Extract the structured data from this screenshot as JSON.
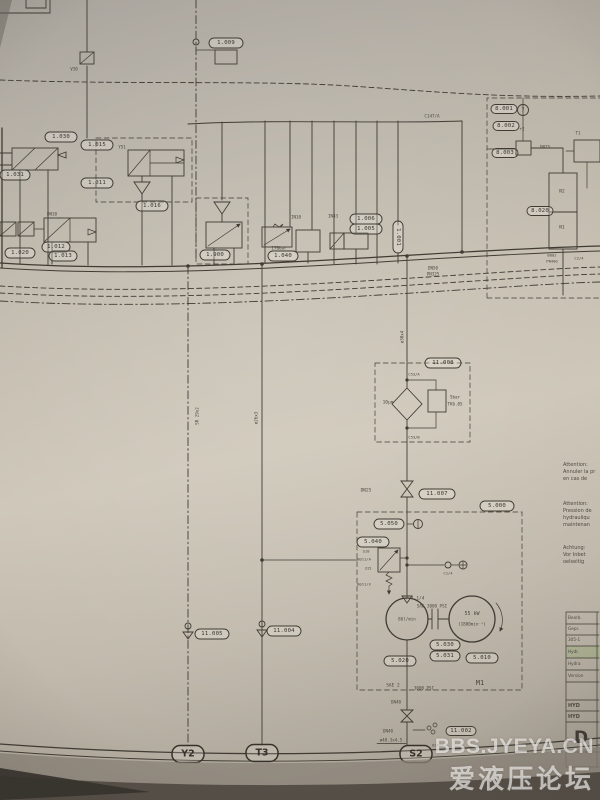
{
  "watermark": {
    "line1": "BBS.JYEYA.CN",
    "line2": "爱液压论坛"
  },
  "terminals": {
    "y2": "Y2",
    "t3": "T3",
    "s2": "S2"
  },
  "tags": {
    "t1009": "1.009",
    "t1030": "1.030",
    "t1031": "1.031",
    "t1015": "1.015",
    "t1011": "1.011",
    "t1016": "1.016",
    "t1020": "1.020",
    "t1012": "1.012",
    "t1013": "1.013",
    "t1900": "1.900",
    "t1040": "1.040",
    "t1006": "1.006",
    "t1005": "1.005",
    "t1001": "1.001",
    "t11008": "11.008",
    "t11007": "11.007",
    "t5000": "5.000",
    "t5050": "5.050",
    "t5040": "5.040",
    "t5020": "5.020",
    "t5030": "5.030",
    "t5031": "5.031",
    "t5010": "5.010",
    "t11005": "11.005",
    "t11004": "11.004",
    "t11002": "11.002",
    "t8001": "8.001",
    "t8002": "8.002",
    "t8003": "8.003",
    "t8020": "8.020",
    "detail7": "7"
  },
  "texts": {
    "v30": "V30",
    "y51": "Y51",
    "dn10": "DN10",
    "in10": "IN10",
    "in43": "IN43",
    "bar170": "170bar",
    "dn50": "DN50",
    "pn325": "PN325",
    "c147": "C147/A",
    "t1": "T1",
    "n2": "N2",
    "n1": "N1",
    "b002": "B002",
    "pn400": "PN400",
    "c24": "C2/4",
    "dn25_right": "DN25",
    "sr29": "SR 29x2",
    "d26": "ø26x3",
    "d30": "ø30x4",
    "um10": "10μm",
    "bar5": "5bar",
    "tk": "TK6.05",
    "c53a": "C53/A",
    "c53b": "C53/B",
    "dn25": "DN25",
    "c14": "C1/4",
    "s10": "S10",
    "b011a": "B011/A",
    "v315": "315",
    "b011x": "B011/X",
    "p114": "P 1 1/4",
    "sae3000": "SAE 3000 PSI",
    "pumpflow": "86l/min",
    "kw": "55 kW",
    "rpm": "(1800min⁻¹)",
    "m1": "M1",
    "sae2": "SAE 2",
    "psi3000": "3000 PSI",
    "dn40a": "DN40",
    "dn40b": "DN40",
    "pipe": "ø48.3x4.5",
    "b1000": "B1000",
    "plus2": "+2"
  },
  "notes": {
    "fr1": [
      "Attention:",
      "Annuler la pr",
      "en cas de"
    ],
    "fr2": [
      "Attention:",
      "Pression de",
      "hydrauliqu",
      "maintenan"
    ],
    "de": [
      "Achtung:",
      "Vor Inbet",
      "oelseitig"
    ]
  },
  "title_block": {
    "rows": [
      "Bearb.",
      "Gepr.",
      "305-1",
      "Hydr.",
      "Hydra",
      "Version"
    ],
    "name1": "HYD",
    "name2": "HYD",
    "letter": "D"
  }
}
